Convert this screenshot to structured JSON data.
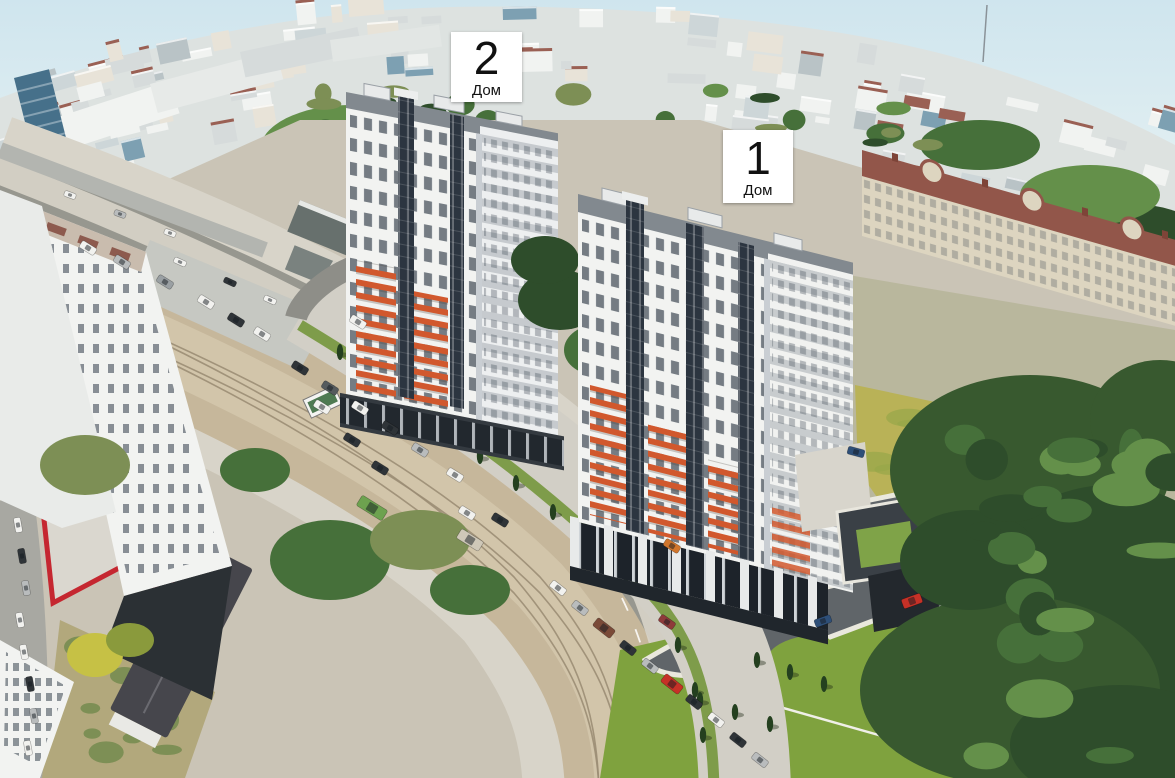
{
  "annotations": {
    "house_2": {
      "number": "2",
      "caption": "Дом"
    },
    "house_1": {
      "number": "1",
      "caption": "Дом"
    }
  },
  "colors": {
    "sky_top": "#cfe5ee",
    "sky_horizon": "#f0f7f5",
    "city_base": "#dde2e0",
    "city_light": "#f1f3f1",
    "city_mid": "#d6dbdb",
    "city_grey": "#b9c3c6",
    "city_blue": "#7da0b2",
    "city_blue_dark": "#46708a",
    "city_roof_red": "#9a6054",
    "tree_dark": "#2e4d2b",
    "tree_mid": "#46703a",
    "tree_light": "#64904a",
    "tree_olive": "#7d8f55",
    "ground_base": "#cac4b6",
    "dirt": "#c6b79b",
    "dirt_light": "#d4c8ae",
    "paved": "#97978f",
    "sidewalk": "#d8d4c9",
    "building_white": "#f2f3f1",
    "building_shade": "#c9ced3",
    "window_dark": "#39434f",
    "accent_orange": "#d1582d",
    "red_building": "#c52730",
    "dark_glass": "#191b1f",
    "roof_grey": "#82898f",
    "podium_dark": "#343a40",
    "asphalt": "#606569",
    "curb": "#eae8dd",
    "lawn_green": "#7fa23e",
    "lawn_yellow": "#b9b257",
    "classical_facade": "#ddd5c0",
    "classical_roof": "#92564a",
    "dark_roof": "#46464c",
    "dry_grass": "#b2a87c",
    "car_white": "#f2f2ef",
    "car_grey": "#b9bcbd",
    "car_dark": "#2f3438",
    "car_red": "#c63127",
    "car_green": "#6da24f",
    "car_blue": "#2e4f78",
    "car_orange": "#d1762c",
    "label_bg": "#ffffff",
    "label_text": "#111111"
  }
}
